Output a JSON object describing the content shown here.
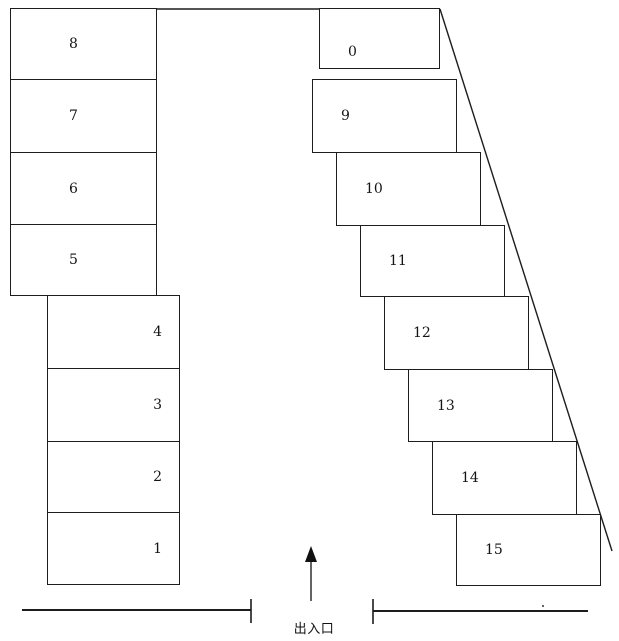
{
  "diagram": {
    "kind": "parking-lot-layout",
    "colors": {
      "background": "#ffffff",
      "line": "#1d1d1d",
      "text": "#141414"
    },
    "entrance": {
      "label": "出入口",
      "arrow_icon": "up-arrow"
    },
    "spaces": {
      "left_upper": [
        {
          "label": "8"
        },
        {
          "label": "7"
        },
        {
          "label": "6"
        },
        {
          "label": "5"
        }
      ],
      "left_lower": [
        {
          "label": "4"
        },
        {
          "label": "3"
        },
        {
          "label": "2"
        },
        {
          "label": "1"
        }
      ],
      "right": [
        {
          "label": "0"
        },
        {
          "label": "9"
        },
        {
          "label": "10"
        },
        {
          "label": "11"
        },
        {
          "label": "12"
        },
        {
          "label": "13"
        },
        {
          "label": "14"
        },
        {
          "label": "15"
        }
      ]
    }
  }
}
